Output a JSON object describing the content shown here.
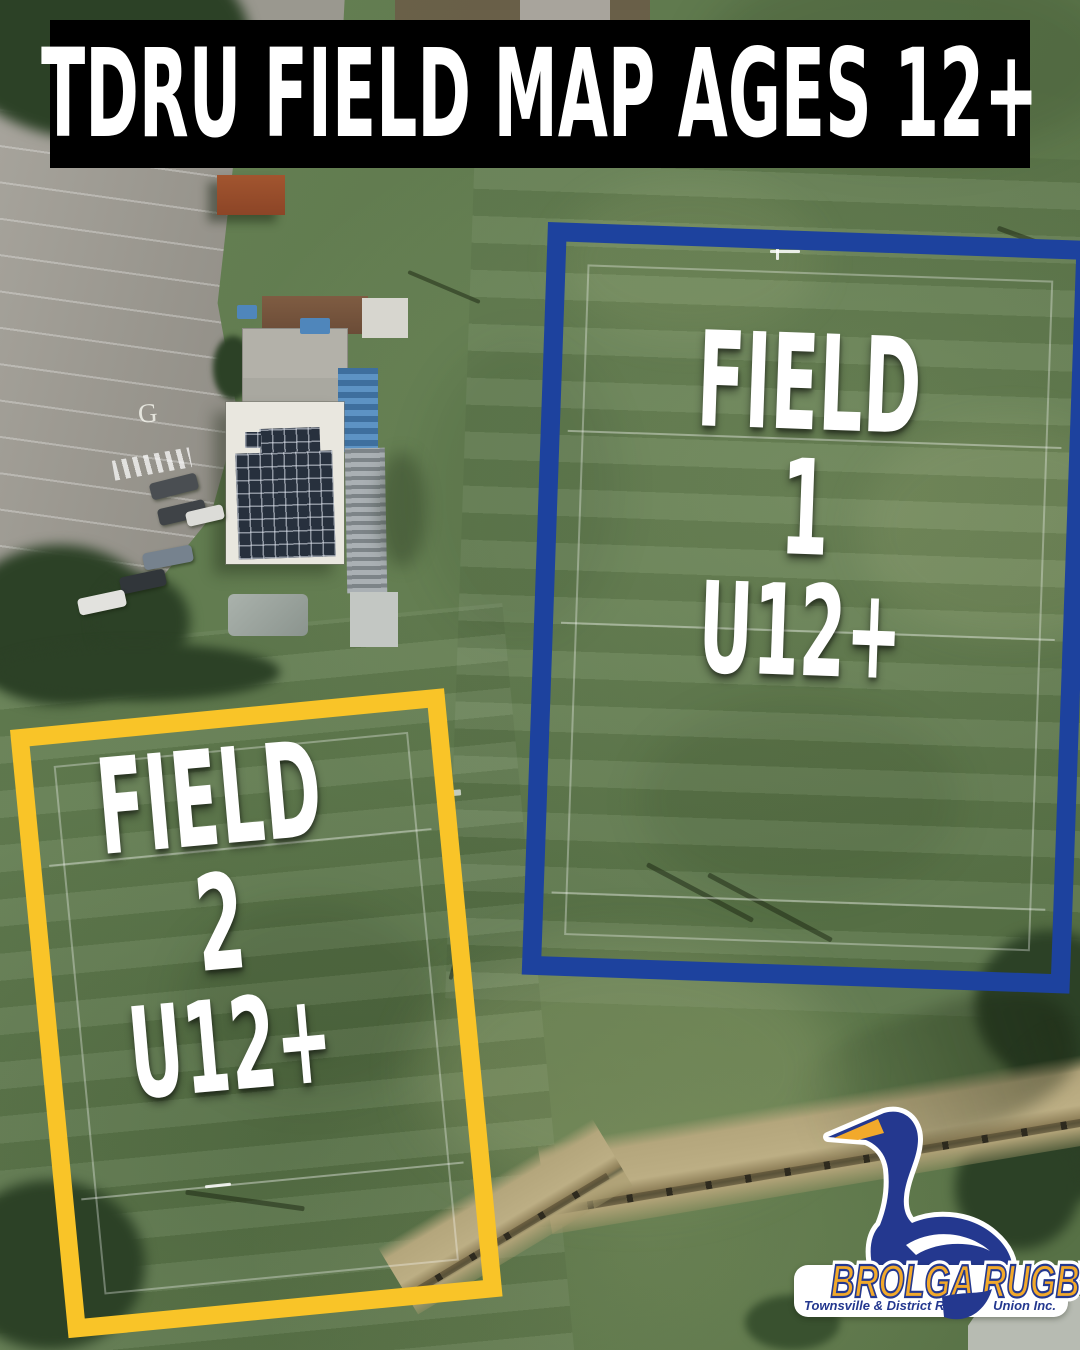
{
  "banner": {
    "title": "TDRU FIELD MAP AGES 12+"
  },
  "fields": {
    "field1": {
      "name": "FIELD 1",
      "age": "U12+"
    },
    "field2": {
      "name": "FIELD 2",
      "age": "U12+"
    }
  },
  "ground": {
    "parking_marking": "G"
  },
  "logo": {
    "brand": "BROLGA RUGBY",
    "tagline_left": "Townsville & District Rugby",
    "tagline_right": "Union Inc."
  },
  "colors": {
    "banner_bg": "#000000",
    "title_text": "#ffffff",
    "label_text": "#ffffff",
    "field1_outline": "#1d429e",
    "field2_outline": "#f9c428",
    "logo_gold": "#f2a92b",
    "logo_blue": "#24388f"
  }
}
